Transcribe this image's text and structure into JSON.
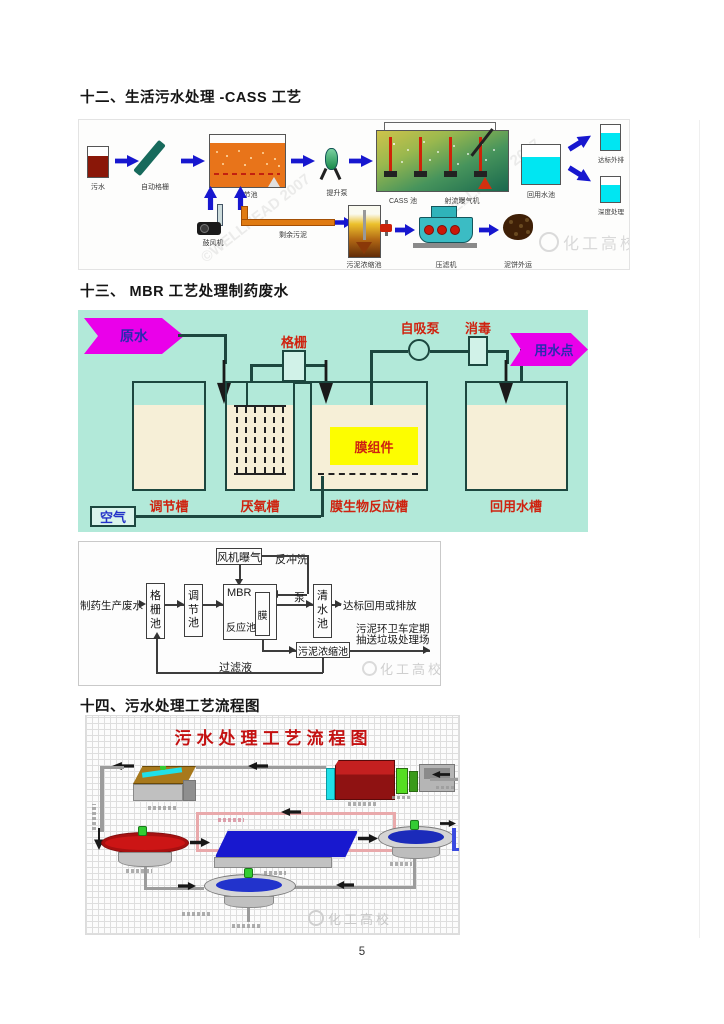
{
  "page": {
    "number": "5"
  },
  "headings": {
    "section12": "十二、生活污水处理 -CASS 工艺",
    "section13": "十三、 MBR 工艺处理制药废水",
    "section14": "十四、污水处理工艺流程图"
  },
  "cass_diagram": {
    "labels": {
      "raw_sewage": "污水",
      "auto_screen": "自动格栅",
      "equalization_tank": "调节池",
      "lift_pump": "提升泵",
      "cass_tank": "CASS 池",
      "jet_aerator": "射流曝气机",
      "reuse_tank": "回用水池",
      "standard_discharge": "达标外排",
      "advanced_treatment": "深度处理",
      "blower": "鼓风机",
      "excess_sludge": "剩余污泥",
      "sludge_thickener": "污泥浓缩池",
      "filter_press": "压滤机",
      "cake_transport": "泥饼外运"
    },
    "watermark_brand": "化工高校",
    "watermark_copyright": "©WELLHEAD 2007"
  },
  "mbr_diagram": {
    "labels": {
      "raw_water": "原水",
      "screen": "格栅",
      "self_priming_pump": "自吸泵",
      "disinfection": "消毒",
      "use_point": "用水点",
      "membrane_module": "膜组件",
      "equalization_tank": "调节槽",
      "anaerobic_tank": "厌氧槽",
      "mbr_tank": "膜生物反应槽",
      "reuse_tank": "回用水槽",
      "air": "空气"
    }
  },
  "mbr_flowchart": {
    "labels": {
      "fan_aeration": "风机曝气",
      "backwash": "反冲洗",
      "influent": "制药生产废水",
      "screen_tank": "格栅池",
      "equalization_tank": "调节池",
      "mbr": "MBR",
      "reactor": "反应池",
      "membrane": "膜",
      "pump": "泵",
      "clean_water_tank": "清水池",
      "effluent": "达标回用或排放",
      "sludge_note_line1": "污泥环卫车定期",
      "sludge_note_line2": "抽送垃圾处理场",
      "sludge_thickener": "污泥浓缩池",
      "filtrate": "过滤液"
    },
    "watermark_brand": "化工高校"
  },
  "sewage_flow_diagram": {
    "title": "污水处理工艺流程图",
    "watermark_brand": "化工高校"
  },
  "colors": {
    "mbr_background": "#b2e9d9",
    "magenta_banner": "#ea00ea",
    "red_label": "#cf2310",
    "blue_arrow": "#1717cf",
    "membrane_module_yellow": "#fdfd00",
    "tank_fill_cream": "#f6efd7",
    "flow_title_red": "#c41111",
    "cyan_water": "#00e6f2"
  }
}
